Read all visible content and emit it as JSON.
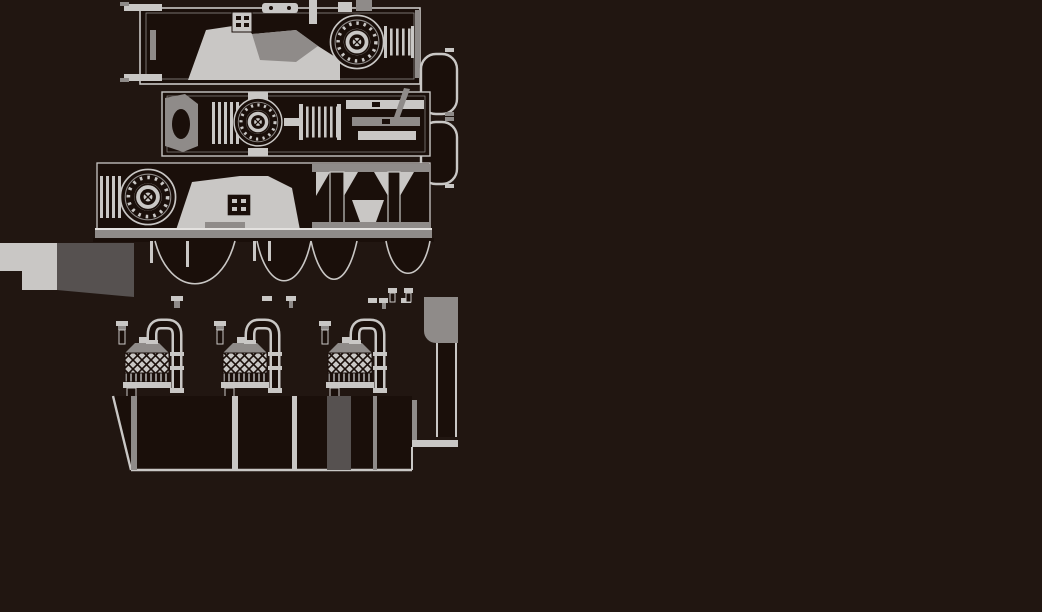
{
  "figure": {
    "type": "technical-drawing",
    "subject": "blower-package-assembly-drawing",
    "text_content": "none",
    "views": [
      {
        "name": "plan-view-a",
        "description": "upper plan view with rotary blower and motor"
      },
      {
        "name": "receiver-tanks",
        "description": "two rounded tanks at right edge"
      },
      {
        "name": "plan-view-b",
        "description": "second plan view with blower, coupling and base plates"
      },
      {
        "name": "front-elevation",
        "description": "front elevation with blower, housing and support frame"
      },
      {
        "name": "foundation-block",
        "description": "stepped foundation block at lower left"
      },
      {
        "name": "pipe-bends",
        "description": "row of pipe bow bends below base frame"
      },
      {
        "name": "piping-elevation",
        "description": "piping elevation with three filter vessels, U-pipes and discharge duct"
      }
    ]
  },
  "palette": {
    "background": "#211611",
    "interior_dark": "#1a0f0a",
    "line_light": "#c9c7c5",
    "line_lighter": "#e4e2e0",
    "line_mid": "#8f8b89",
    "line_dim": "#565150"
  }
}
